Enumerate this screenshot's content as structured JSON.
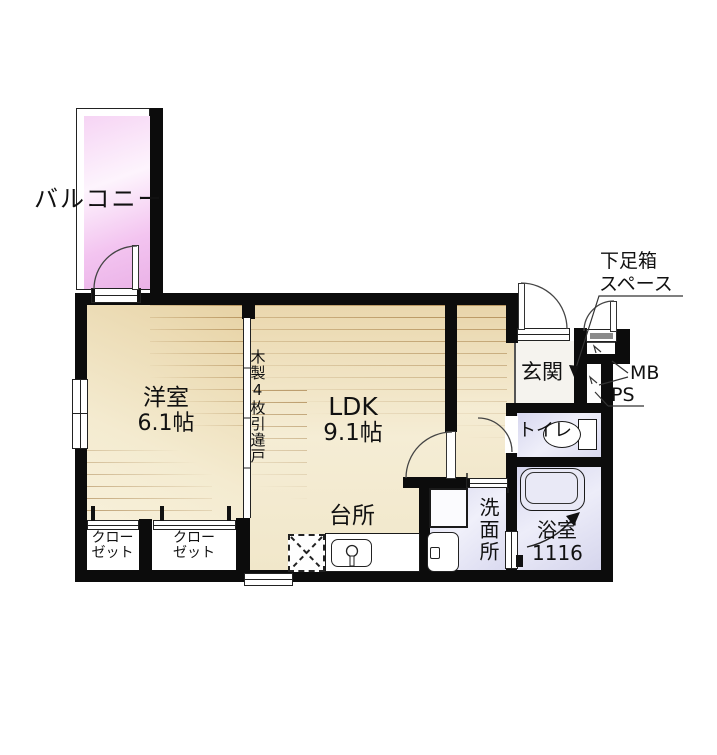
{
  "plan": {
    "balcony": {
      "label": "バルコニー"
    },
    "western_room": {
      "name": "洋室",
      "size": "6.1帖"
    },
    "ldk": {
      "name": "LDK",
      "size": "9.1帖"
    },
    "kitchen": {
      "name": "台所"
    },
    "partition_note": {
      "text": "木製4枚引違戸"
    },
    "entrance": {
      "name": "玄関"
    },
    "toilet": {
      "name": "トイレ"
    },
    "washroom": {
      "name": "洗面所"
    },
    "bathroom": {
      "name": "浴室",
      "size": "1116"
    },
    "closets": [
      {
        "line1": "クロー",
        "line2": "ゼット"
      },
      {
        "line1": "クロー",
        "line2": "ゼット"
      }
    ],
    "shoe_box": {
      "line1": "下足箱",
      "line2": "スペース"
    },
    "pipe_spaces": {
      "mb": "MB",
      "ps": "PS"
    }
  },
  "colors": {
    "wall": "#0c0c0c",
    "wood_floor": "#f3e7c9",
    "wet_floor": "#dcdcf0",
    "balcony_pink": "#f2c3ef",
    "entrance_floor": "#f5f3ee"
  }
}
